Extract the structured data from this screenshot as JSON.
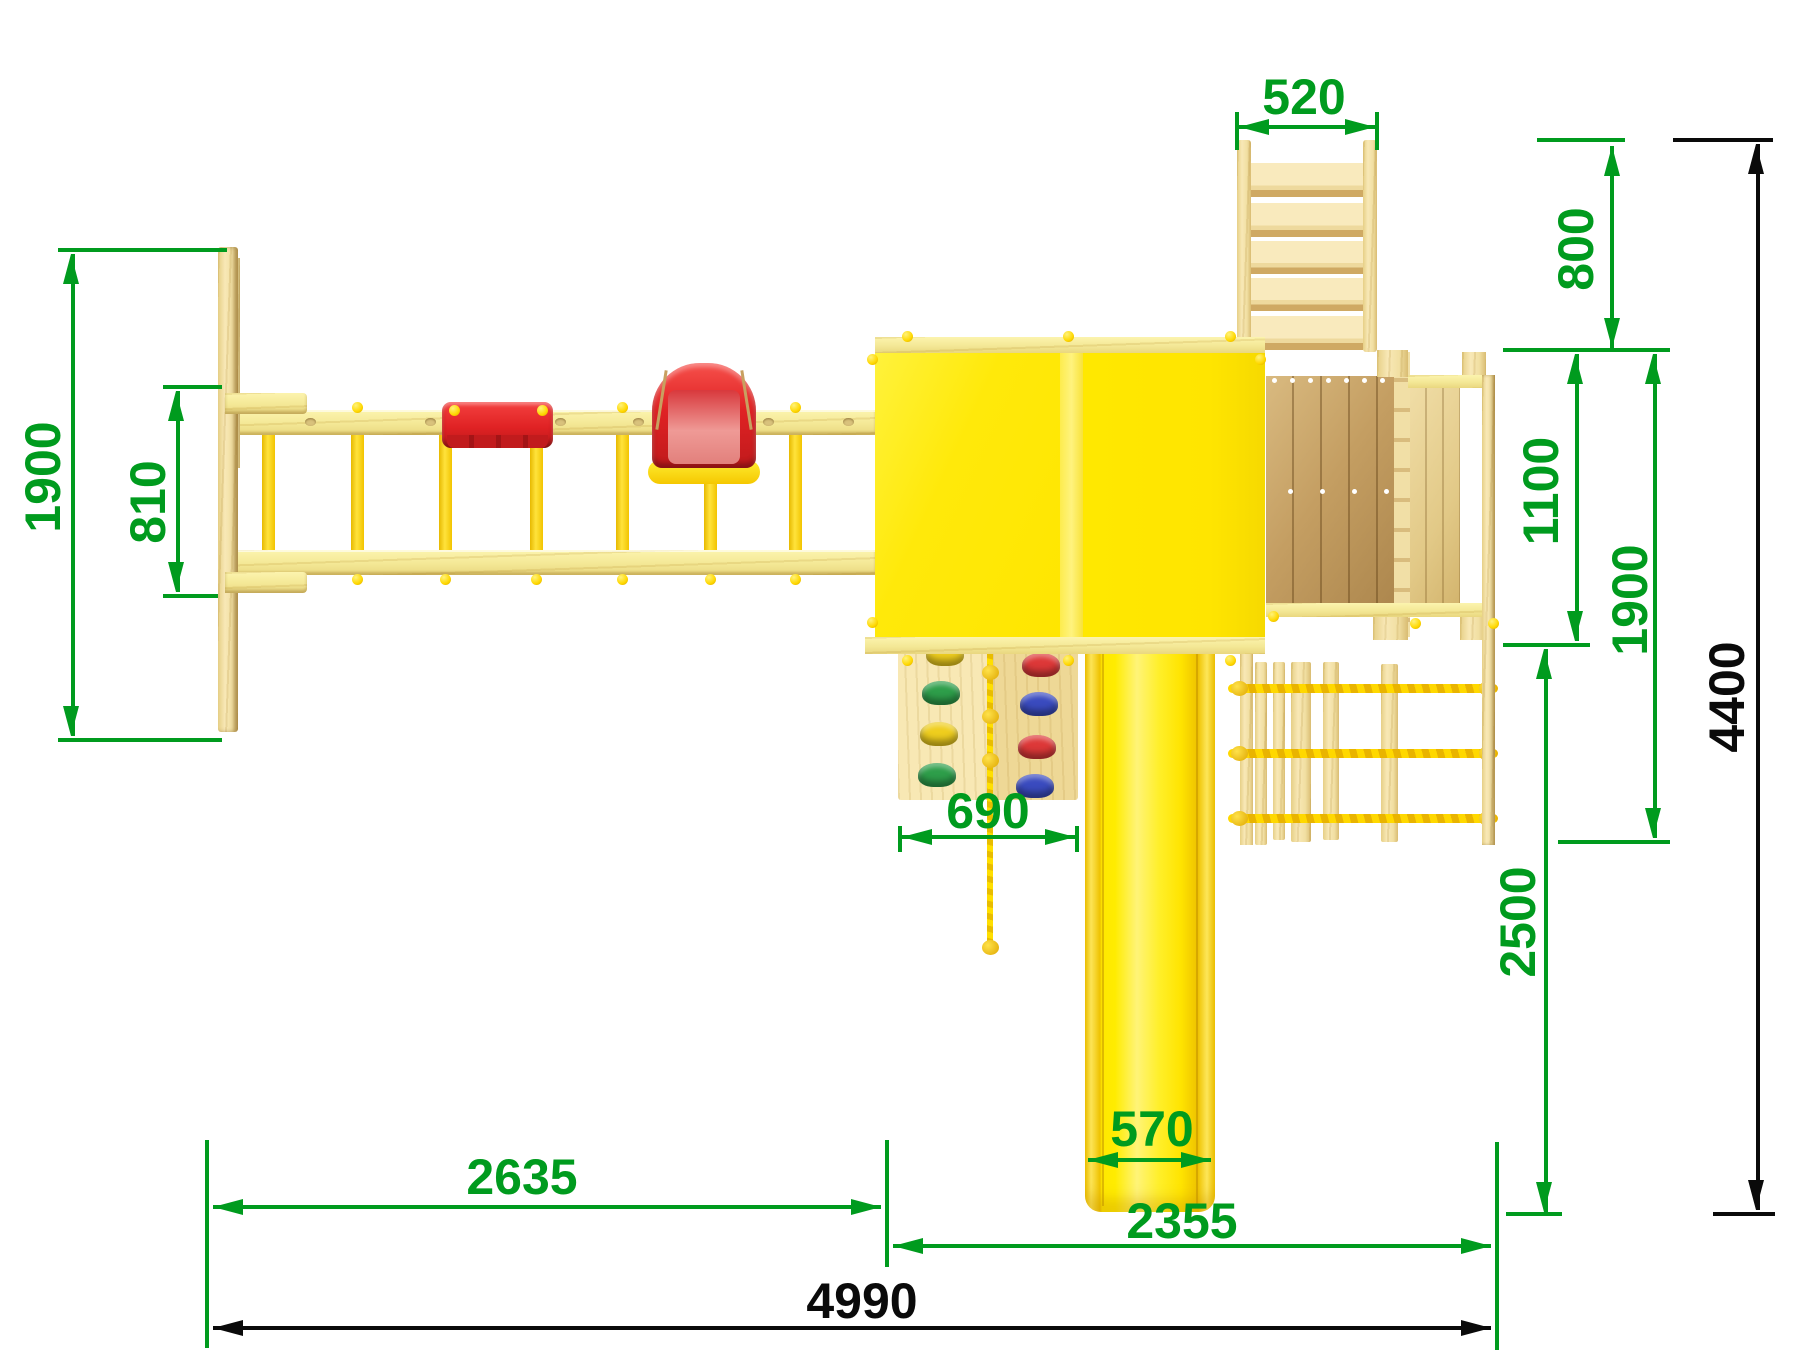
{
  "drawing": {
    "type": "playground-top-view-dimension-drawing",
    "units": "mm",
    "colors": {
      "dimension_green": "#009B1E",
      "dimension_black": "#0A0A0A",
      "roof_yellow": "#FFE90A",
      "slide_yellow": "#FFEB00",
      "accent_yellow": "#FFD800",
      "wood_pale": "#F7EC9B",
      "wood_light": "#F3E2AC",
      "wood_deck": "#C29D63",
      "seat_red": "#E02224",
      "hold_green": "#2E9E4A",
      "hold_yellow": "#EFCE1E",
      "hold_red": "#DD3838",
      "hold_blue": "#3A4BBF"
    },
    "dimensions": {
      "ladder_width": {
        "label": "520",
        "value": 520,
        "orientation": "horizontal"
      },
      "ladder_depth": {
        "label": "800",
        "value": 800,
        "orientation": "vertical"
      },
      "platform_depth": {
        "label": "1100",
        "value": 1100,
        "orientation": "vertical"
      },
      "right_section_depth": {
        "label": "1900",
        "value": 1900,
        "orientation": "vertical"
      },
      "overall_depth": {
        "label": "4400",
        "value": 4400,
        "orientation": "vertical"
      },
      "swing_frame_depth": {
        "label": "1900",
        "value": 1900,
        "orientation": "vertical"
      },
      "swing_frame_inner": {
        "label": "810",
        "value": 810,
        "orientation": "vertical"
      },
      "climbing_wall_width": {
        "label": "690",
        "value": 690,
        "orientation": "horizontal"
      },
      "slide_width": {
        "label": "570",
        "value": 570,
        "orientation": "horizontal"
      },
      "slide_section_length": {
        "label": "2500",
        "value": 2500,
        "orientation": "vertical"
      },
      "swing_section_length": {
        "label": "2635",
        "value": 2635,
        "orientation": "horizontal"
      },
      "tower_section_length": {
        "label": "2355",
        "value": 2355,
        "orientation": "horizontal"
      },
      "overall_length": {
        "label": "4990",
        "value": 4990,
        "orientation": "horizontal"
      }
    }
  }
}
